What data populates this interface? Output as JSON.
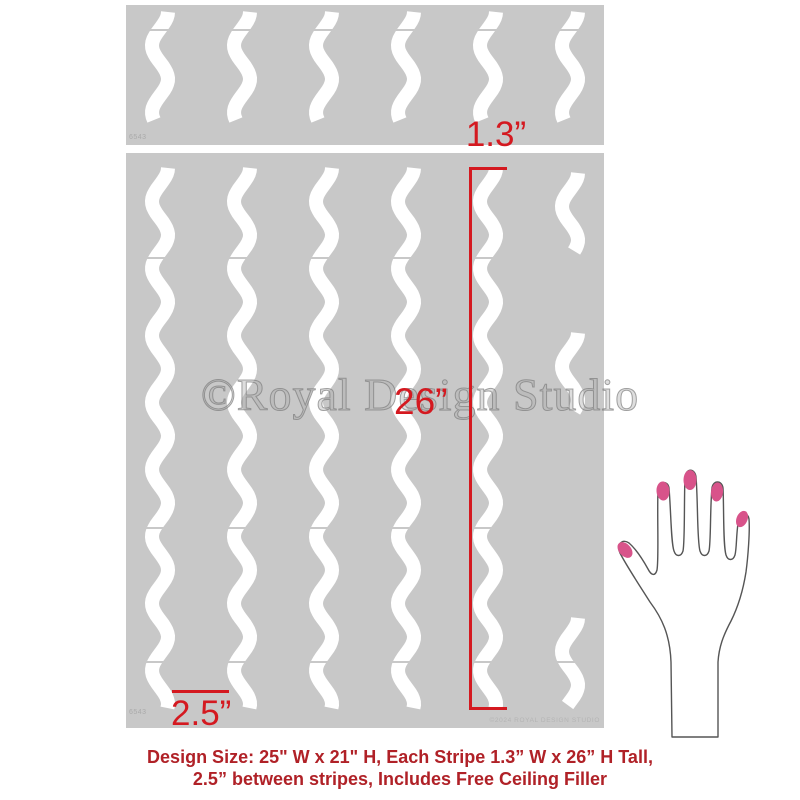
{
  "stencil_product": {
    "watermark_text": "©Royal Design Studio",
    "sheet_code": "6543",
    "copyright_imprint": "©2024 ROYAL DESIGN STUDIO",
    "panel_color": "#c8c8c8",
    "stripe_color": "#ffffff"
  },
  "annotations": {
    "accent_color": "#d41920",
    "stripe_width_label": "1.3”",
    "stripe_height_label": "26”",
    "stripe_gap_label": "2.5”"
  },
  "caption": {
    "color": "#b02127",
    "line1": "Design Size: 25\" W x 21\" H, Each Stripe 1.3” W x 26” H Tall,",
    "line2": "2.5” between stripes, Includes Free Ceiling Filler"
  },
  "hand": {
    "outline_color": "#555555",
    "nail_color": "#d8538a"
  },
  "stencil_geometry": {
    "stripe_centers": [
      34,
      116,
      198,
      280,
      362,
      444
    ],
    "wave": {
      "amplitude": 8,
      "wavelength": 67,
      "stroke_width": 14
    },
    "top_panel": {
      "width": 478,
      "height": 140,
      "stripe_y": [
        7,
        115
      ],
      "seams": [
        25
      ]
    },
    "main_panel": {
      "width": 478,
      "height": 575,
      "stripe_y": [
        15,
        557
      ],
      "filler_column_index": 5,
      "filler_segments": [
        [
          20,
          99
        ],
        [
          180,
          260
        ],
        [
          465,
          552
        ]
      ],
      "seams": [
        105,
        375,
        509
      ]
    }
  }
}
